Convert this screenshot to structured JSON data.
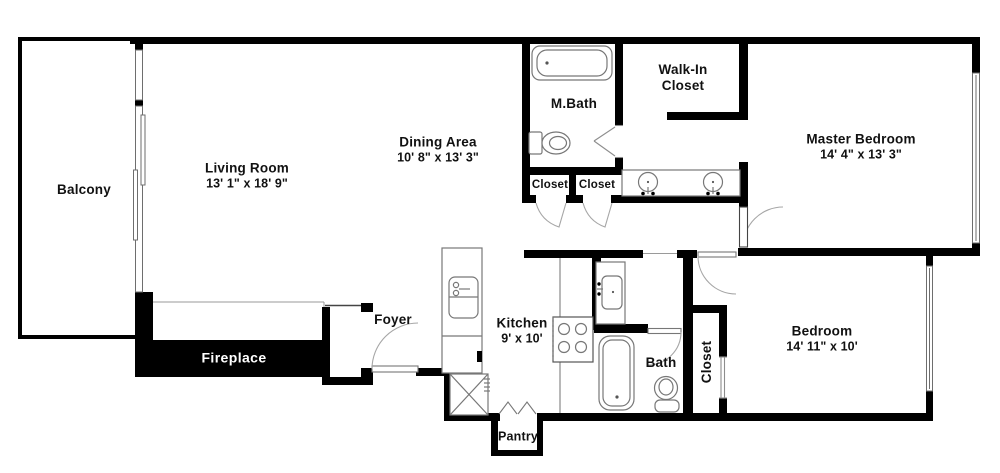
{
  "title": "Apartment Floor Plan",
  "colors": {
    "walls": "#000000",
    "background": "#ffffff",
    "fixture_stroke": "#777777",
    "door_arc": "#a6a6a6",
    "fireplace_text": "#ffffff"
  },
  "labels": {
    "balcony": {
      "name": "Balcony"
    },
    "living_room": {
      "name": "Living Room",
      "dims": "13' 1\" x 18' 9\""
    },
    "dining_area": {
      "name": "Dining Area",
      "dims": "10' 8\" x 13' 3\""
    },
    "master_bath": {
      "name": "M.Bath"
    },
    "walk_in_closet": {
      "line1": "Walk-In",
      "line2": "Closet"
    },
    "master_bedroom": {
      "name": "Master Bedroom",
      "dims": "14' 4\" x 13' 3\""
    },
    "closet_a": {
      "name": "Closet"
    },
    "closet_b": {
      "name": "Closet"
    },
    "fireplace": {
      "name": "Fireplace"
    },
    "foyer": {
      "name": "Foyer"
    },
    "kitchen": {
      "name": "Kitchen",
      "dims": "9' x 10'"
    },
    "bath": {
      "name": "Bath"
    },
    "bedroom_closet": {
      "name": "Closet"
    },
    "bedroom": {
      "name": "Bedroom",
      "dims": "14' 11\" x 10'"
    },
    "pantry": {
      "name": "Pantry"
    }
  },
  "fixtures": {
    "master_bathtub": "bathtub",
    "master_toilet": "toilet",
    "hall_vanity": "double-sink-vanity",
    "kitchen_sink": "kitchen-sink-counter",
    "stove": "four-burner-cooktop",
    "washer": "stacked-washer-dryer",
    "bath_sink": "vanity-sink",
    "bath_tub": "bathtub",
    "bath_toilet": "toilet",
    "sliding_door": "balcony-sliding-door",
    "windows": "window"
  }
}
